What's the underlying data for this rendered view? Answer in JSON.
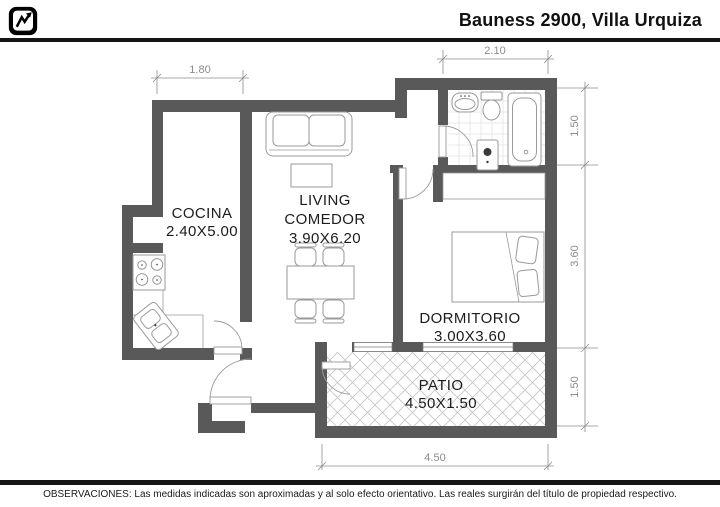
{
  "header": {
    "title": "Bauness 2900, Villa Urquiza",
    "logo_icon": "chart-pulse-logo"
  },
  "plan": {
    "rooms": [
      {
        "name": "COCINA",
        "size": "2.40X5.00"
      },
      {
        "name": "LIVING",
        "name_line2": "COMEDOR",
        "size": "3.90X6.20"
      },
      {
        "name": "DORMITORIO",
        "size": "3.00X3.60"
      },
      {
        "name": "PATIO",
        "size": "4.50X1.50"
      }
    ],
    "dimensions": {
      "kitchen_top": "1.80",
      "bathroom_top": "2.10",
      "right_bathroom": "1.50",
      "right_bedroom": "3.60",
      "right_patio": "1.50",
      "bottom_patio": "4.50"
    },
    "fixtures": [
      "sofa",
      "coffee-table",
      "dining-table",
      "dining-chairs",
      "stove",
      "kitchen-sink",
      "counter",
      "bed",
      "pillows",
      "closet",
      "bathroom-sink",
      "toilet",
      "bathtub",
      "bidet",
      "patio-hatch",
      "windows",
      "doors"
    ]
  },
  "footer": {
    "observations": "OBSERVACIONES: Las medidas indicadas son aproximadas y al solo efecto orientativo. Las reales surgirán del título de propiedad respectivo."
  },
  "colors": {
    "wall": "#595959",
    "fixture": "#9a9a9a",
    "dim": "#8c8c8c",
    "text": "#1c1c1c",
    "rule": "#151515",
    "hatch": "#c4c4c4",
    "tile": "#e2e2e2"
  }
}
